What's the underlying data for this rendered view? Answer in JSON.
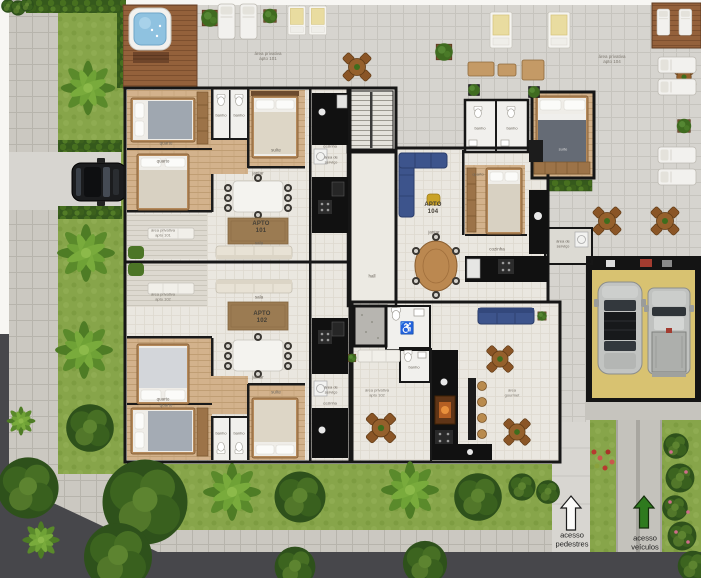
{
  "apartments": {
    "a101": {
      "title": "APTO",
      "number": "101"
    },
    "a102": {
      "title": "APTO",
      "number": "102"
    },
    "a104": {
      "title": "APTO",
      "number": "104"
    }
  },
  "areas": {
    "priv101": {
      "l1": "área privativa",
      "l2": "apto 101"
    },
    "priv102": {
      "l1": "área privativa",
      "l2": "apto 102"
    },
    "priv104": {
      "l1": "área privativa",
      "l2": "apto 104"
    },
    "gourmet": {
      "l1": "área",
      "l2": "gourmet"
    },
    "servico": {
      "l1": "área de",
      "l2": "serviço"
    }
  },
  "rooms": {
    "quarto": "quarto",
    "suite": "suíte",
    "sala": "sala",
    "jantar": "jantar",
    "cozinha": "cozinha",
    "banho": "banho",
    "hall": "hall"
  },
  "access": {
    "pedestrian": {
      "l1": "acesso",
      "l2": "pedestres"
    },
    "vehicles": {
      "l1": "acesso",
      "l2": "veículos"
    }
  },
  "icons": {
    "wheelchair": "♿"
  },
  "colors": {
    "grass": "#87a54a",
    "street": "#47474b",
    "sidewalk": "#cbc8c1",
    "deck_wood": "#94613b",
    "wall": "#161616",
    "spa_water": "#8fc2e0",
    "garage_floor": "#d8c271",
    "sofa_blue": "#3d548c",
    "arrow_green": "#2e7a1e"
  }
}
